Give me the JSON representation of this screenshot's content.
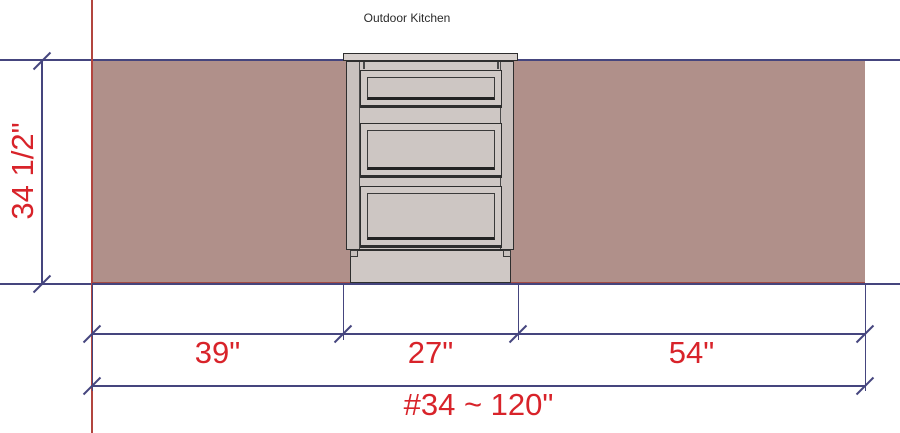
{
  "title": "Outdoor Kitchen",
  "dimensions": {
    "height_label": "34 1/2\"",
    "segments": [
      {
        "label": "39\""
      },
      {
        "label": "27\""
      },
      {
        "label": "54\""
      }
    ],
    "total_label": "#34 ~ 120\""
  },
  "cabinet": {
    "type": "three-drawer-base-cabinet",
    "drawer_count": 3
  },
  "colors": {
    "dimension_text": "#d8232a",
    "dimension_line": "#45457e",
    "wall_fill": "#b0908a",
    "wall_cut_line": "#b2453f",
    "cabinet_fill": "#cec7c4",
    "cabinet_outline": "#2e2e2e",
    "background": "#ffffff"
  }
}
